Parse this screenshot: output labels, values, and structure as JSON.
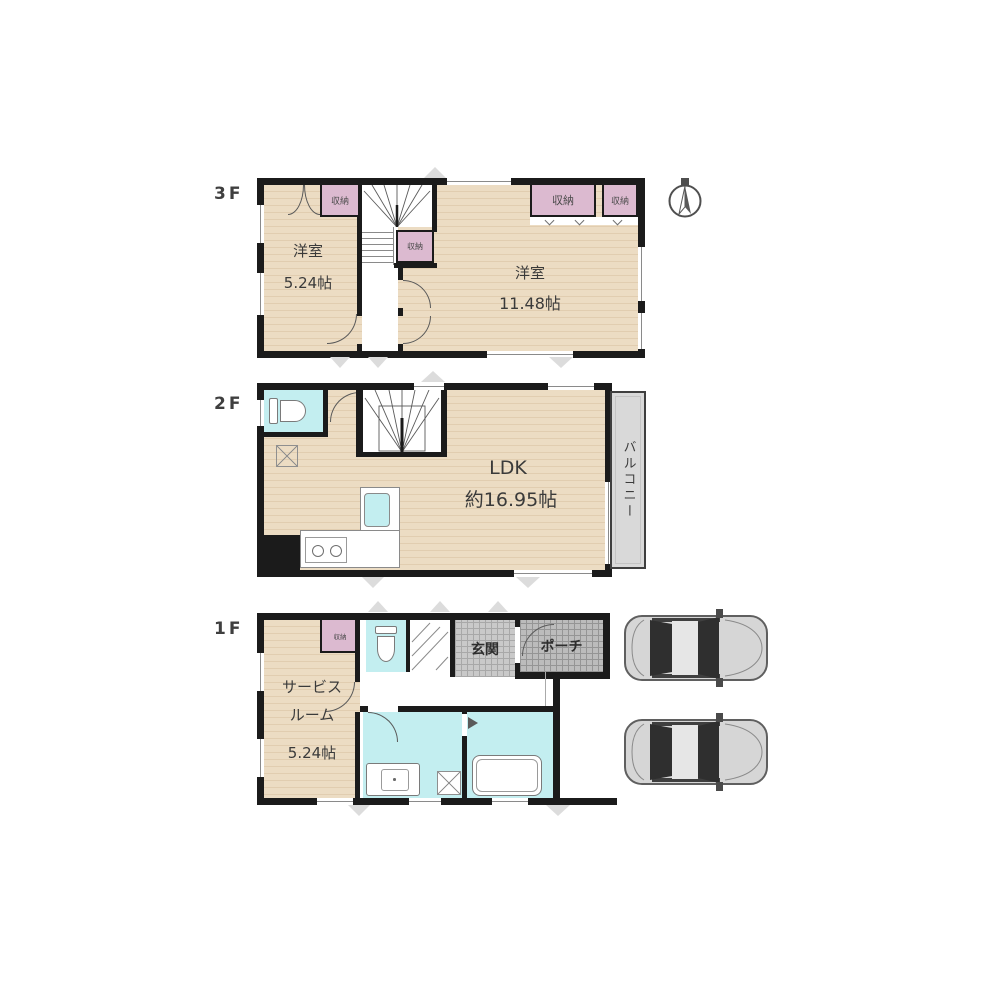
{
  "plan": {
    "type": "residential-floor-plan",
    "compass": "north-indicator",
    "parking_cars": 2
  },
  "colors": {
    "wall": "#1b1b1b",
    "floor_wood": "#ecdcc3",
    "closet_pink": "#dcbad0",
    "wet_area_cyan": "#c3eef0",
    "entrance_tile": "#c9c9c9",
    "porch_tile": "#bcbcbc",
    "balcony_gray": "#d9d9d9",
    "car_gray": "#d6d6d6"
  },
  "floors": {
    "f3": {
      "label": "3F",
      "room_small": {
        "name": "洋室",
        "size": "5.24帖"
      },
      "room_large": {
        "name": "洋室",
        "size": "11.48帖"
      },
      "closet_a": "収納",
      "closet_b": "収納",
      "closet_c": "収納",
      "closet_d": "収納"
    },
    "f2": {
      "label": "2F",
      "ldk": {
        "name": "LDK",
        "size": "約16.95帖"
      },
      "balcony": "バルコニー"
    },
    "f1": {
      "label": "1F",
      "service_room": {
        "line1": "サービス",
        "line2": "ルーム",
        "size": "5.24帖"
      },
      "entrance": "玄関",
      "porch": "ポーチ",
      "closet": "収納"
    }
  }
}
